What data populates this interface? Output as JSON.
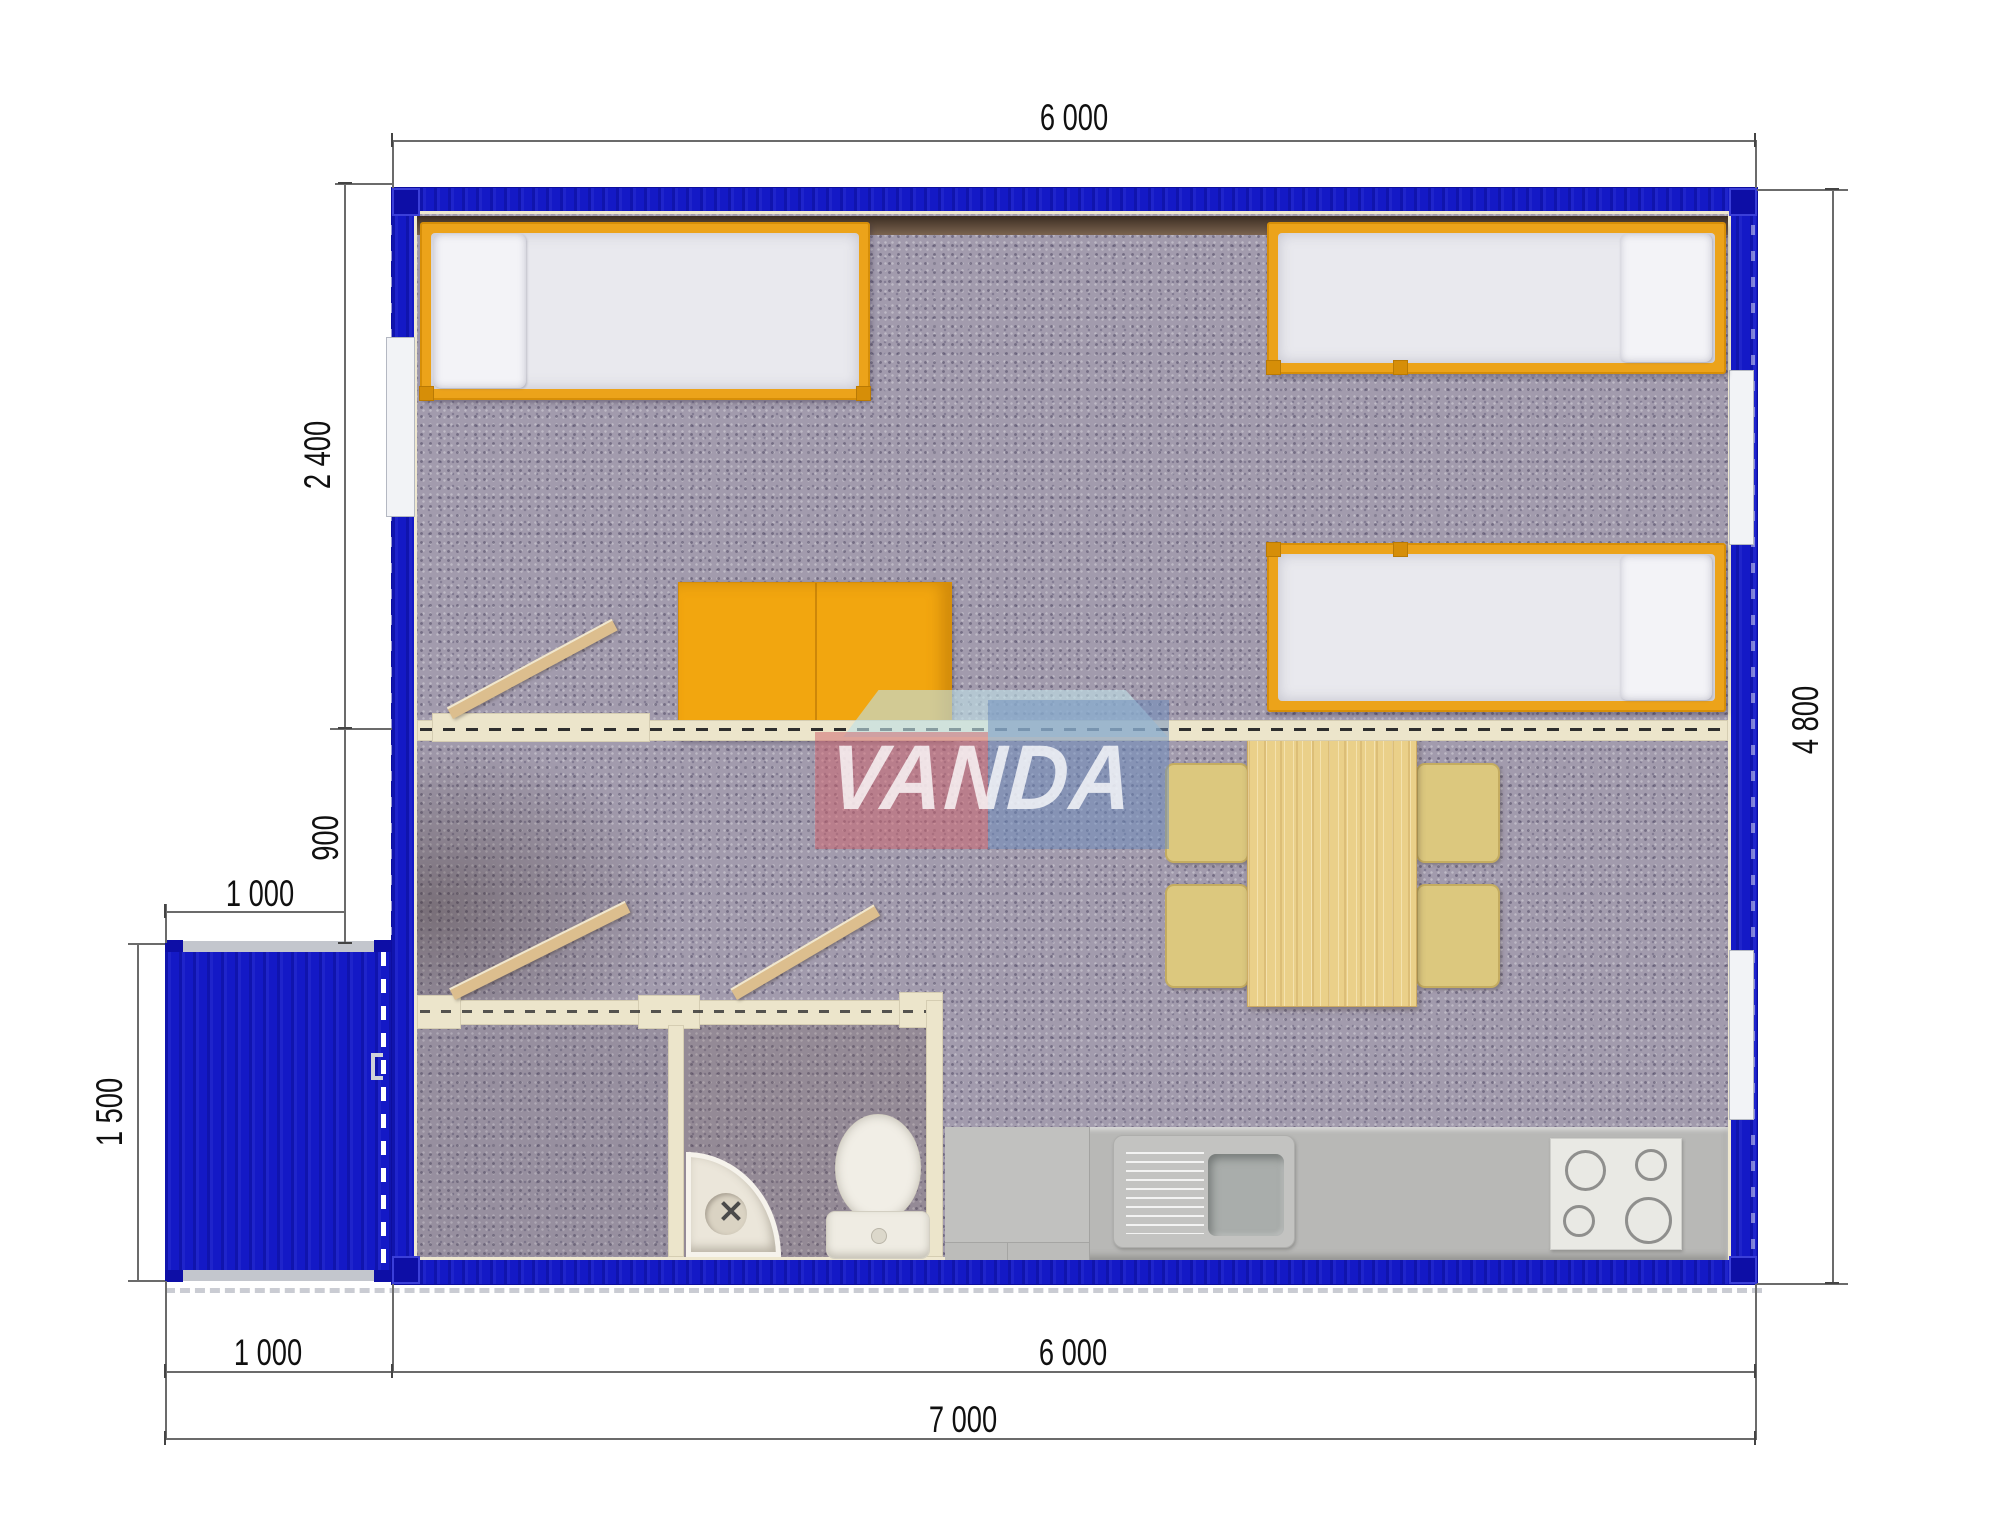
{
  "plan": {
    "type": "modular-container-house floor plan, top view render",
    "watermark": {
      "text": "VANDA"
    },
    "dimensions": {
      "top_width": "6 000",
      "left_bedroom_depth": "2 400",
      "left_corridor_depth": "900",
      "porch_width_top": "1 000",
      "porch_depth": "1 500",
      "right_total_depth": "4 800",
      "bottom_porch_width": "1 000",
      "bottom_building_width": "6 000",
      "bottom_total_width": "7 000"
    },
    "colors": {
      "wall_blue": "#1419c6",
      "partition_cream": "#ece5cb",
      "furniture_orange": "#eca31a",
      "carpet": "#a29bad",
      "wood": "#ead089",
      "kitchen_counter": "#b8b8b6",
      "logo_pink": "#d06670",
      "logo_blue": "#6a8cbe",
      "logo_teal": "#bee0e6"
    },
    "rooms_furniture": [
      "three single beds",
      "orange desk",
      "dining table with four chairs",
      "shower room",
      "wc with corner sink and toilet",
      "kitchen counter with sink and 4-burner stove",
      "entry porch with open door"
    ]
  }
}
